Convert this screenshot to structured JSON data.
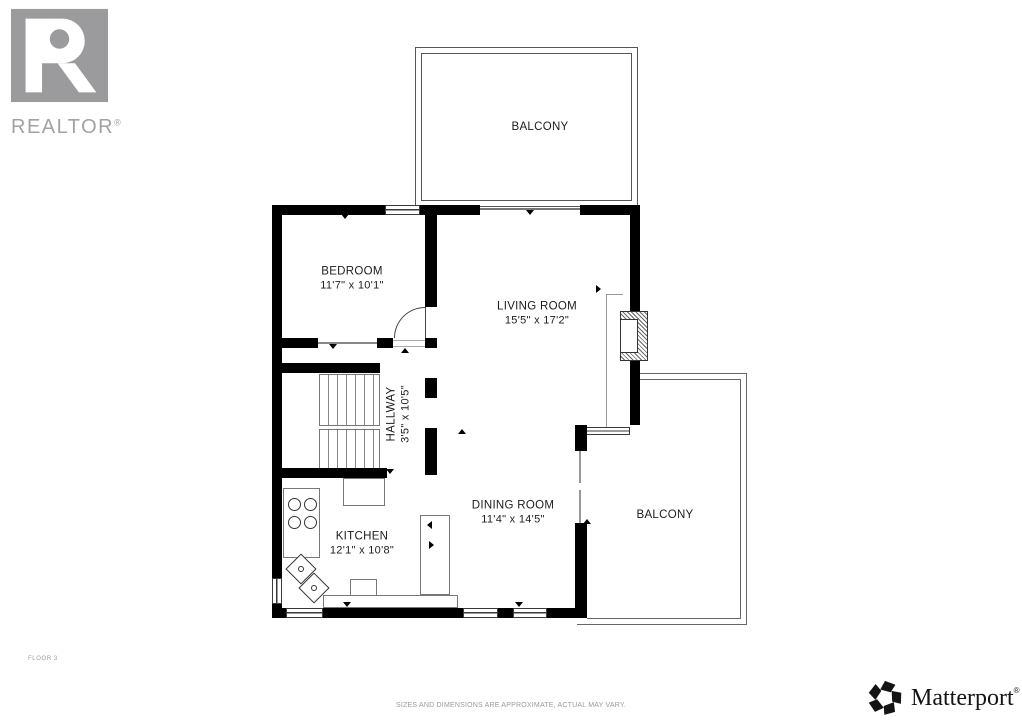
{
  "branding": {
    "realtor": {
      "wordmark_main": "REALTOR",
      "registered": "®"
    },
    "matterport": {
      "wordmark": "Matterport",
      "registered": "®"
    }
  },
  "plan": {
    "floor_label": "FLOOR 3",
    "disclaimer": "SIZES AND DIMENSIONS ARE APPROXIMATE, ACTUAL MAY VARY.",
    "rooms": [
      {
        "id": "balcony-top",
        "name": "BALCONY",
        "dims": ""
      },
      {
        "id": "bedroom",
        "name": "BEDROOM",
        "dims": "11'7\" x 10'1\""
      },
      {
        "id": "living-room",
        "name": "LIVING ROOM",
        "dims": "15'5\" x 17'2\""
      },
      {
        "id": "hallway",
        "name": "HALLWAY",
        "dims": "3'5\" x 10'5\""
      },
      {
        "id": "dining-room",
        "name": "DINING ROOM",
        "dims": "11'4\" x 14'5\""
      },
      {
        "id": "kitchen",
        "name": "KITCHEN",
        "dims": "12'1\" x 10'8\""
      },
      {
        "id": "balcony-right",
        "name": "BALCONY",
        "dims": ""
      }
    ]
  },
  "colors": {
    "wall": "#000000",
    "logo_gray": "#9b9b9d",
    "muted_text": "#9a9a9a",
    "plan_line": "#555555"
  }
}
